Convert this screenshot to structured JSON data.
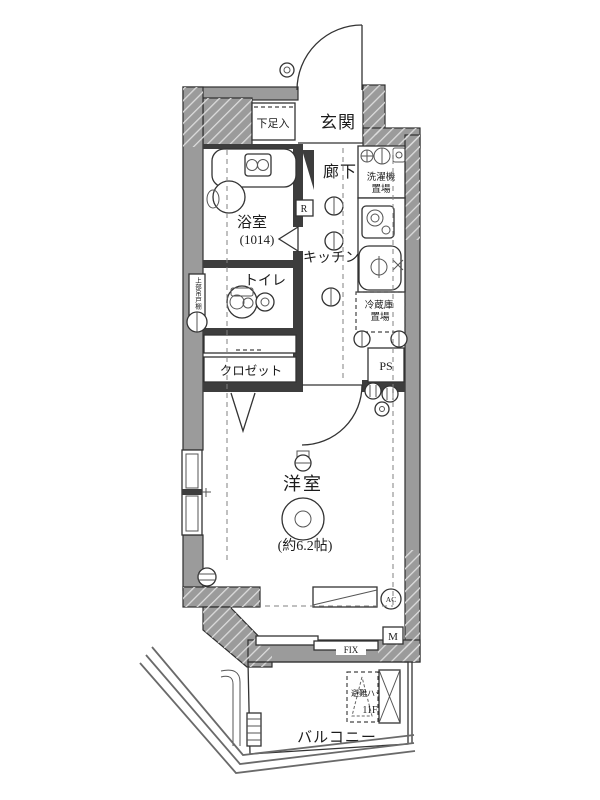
{
  "rooms": {
    "entrance": {
      "label": "玄関"
    },
    "shoe_storage": {
      "label": "下足入"
    },
    "hallway": {
      "label": "廊下"
    },
    "bathroom": {
      "label": "浴室",
      "size": "(1014)"
    },
    "toilet": {
      "label": "トイレ"
    },
    "kitchen": {
      "label": "キッチン"
    },
    "closet": {
      "label": "クロゼット"
    },
    "western_room": {
      "label": "洋室",
      "size": "(約6.2帖)"
    },
    "balcony": {
      "label": "バルコニー"
    }
  },
  "fixtures": {
    "washing_machine": {
      "line1": "洗濯機",
      "line2": "置場"
    },
    "refrigerator": {
      "line1": "冷蔵庫",
      "line2": "置場"
    },
    "pipe_space": {
      "label": "PS"
    },
    "overhead_cabinet": {
      "label": "上部吊戸棚"
    },
    "evacuation_hatch": {
      "line1": "避難ハッチ",
      "line2": "11F"
    }
  },
  "annotations": {
    "fix_window": "FIX",
    "meter_box": "M",
    "r_box": "R",
    "air_conditioner": "AC"
  },
  "colors": {
    "wall_gray": "#9b9b9b",
    "line": "#333333",
    "background": "#ffffff"
  }
}
